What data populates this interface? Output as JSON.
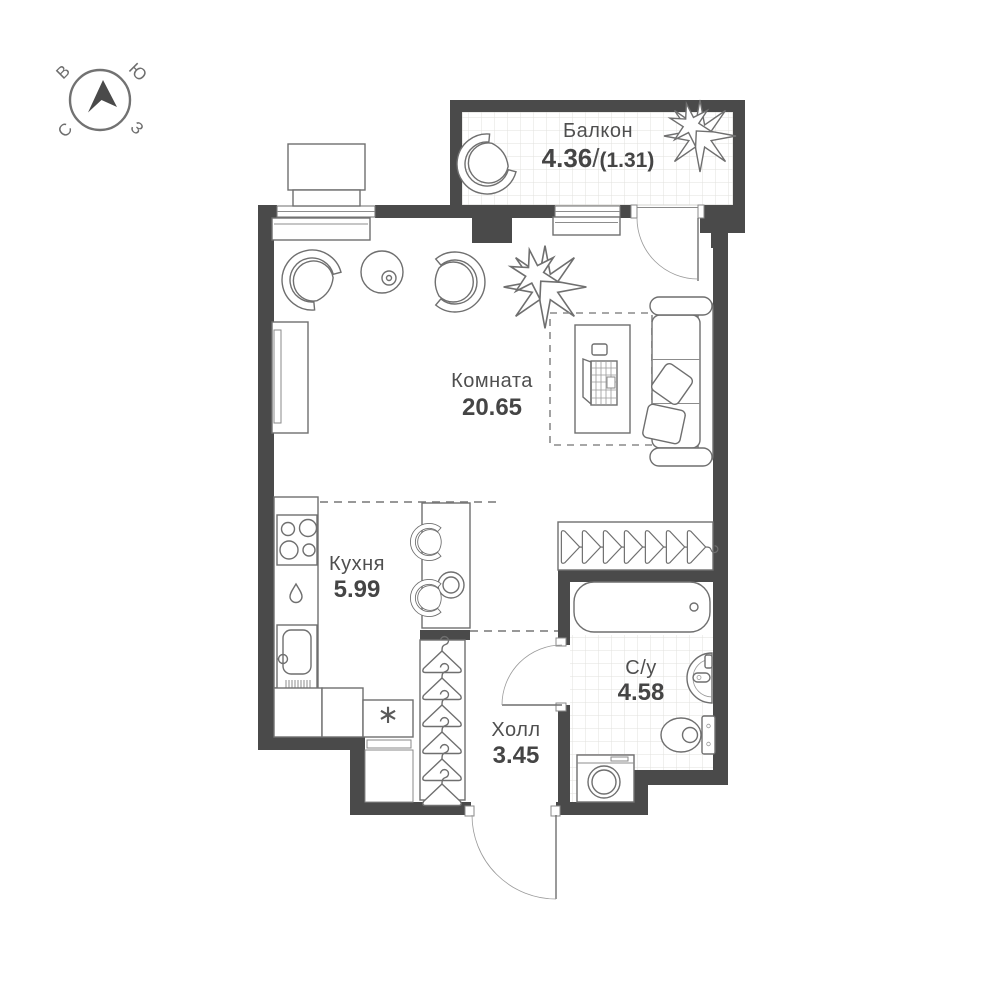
{
  "compass": {
    "letters": {
      "v": "В",
      "yu": "Ю",
      "s": "С",
      "z": "З"
    }
  },
  "rooms": {
    "balcony": {
      "label": "Балкон",
      "area": "4.36",
      "separator": "/",
      "area_secondary": "(1.31)"
    },
    "living_room": {
      "label": "Комната",
      "area": "20.65"
    },
    "kitchen": {
      "label": "Кухня",
      "area": "5.99"
    },
    "hall": {
      "label": "Холл",
      "area": "3.45"
    },
    "bathroom": {
      "label": "С/у",
      "area": "4.58"
    }
  },
  "symbols": {
    "fridge_mark": "∗"
  },
  "colors": {
    "wall": "#4a4a4a",
    "furniture_line": "#6f6f6f",
    "tile_line": "#e2e0dd",
    "label_text": "#4f4f4f",
    "area_text": "#454545",
    "background": "#ffffff"
  }
}
